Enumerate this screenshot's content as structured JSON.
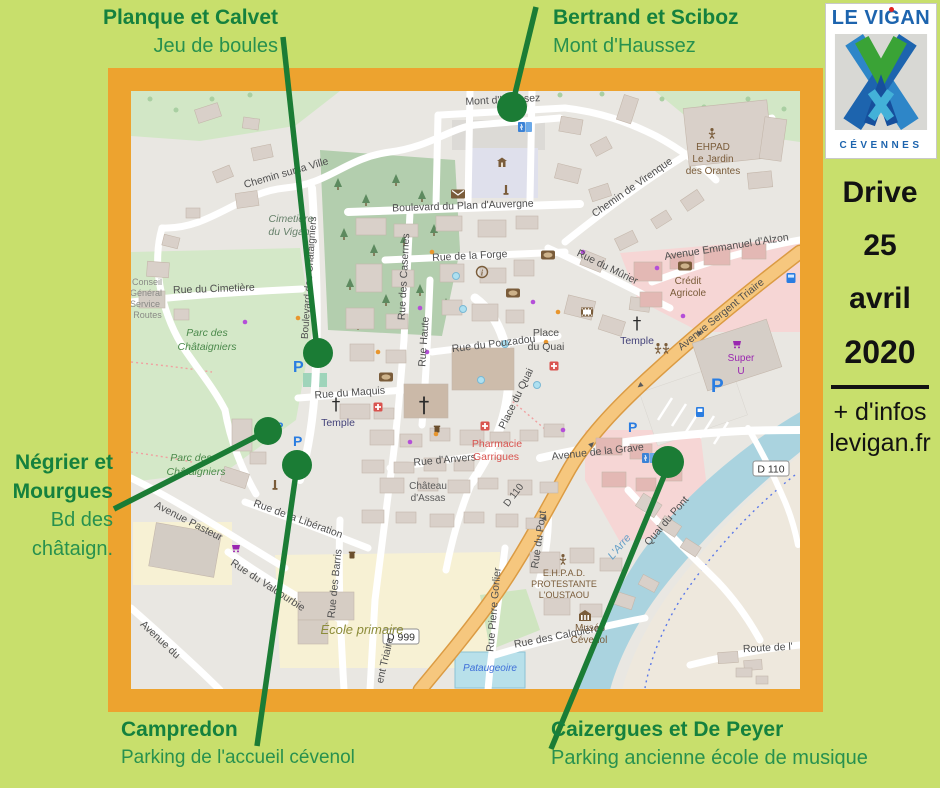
{
  "background_color": "#c8df6c",
  "frame_color": "#eda32f",
  "marker_color": "#1b7c35",
  "callouts": {
    "planque": {
      "title": "Planque et Calvet",
      "subtitle": "Jeu de boules"
    },
    "bertrand": {
      "title": "Bertrand et Sciboz",
      "subtitle": "Mont d'Haussez"
    },
    "negrier": {
      "title_line1": "Négrier et",
      "title_line2": "Mourgues",
      "subtitle_line1": "Bd des",
      "subtitle_line2": "châtaign."
    },
    "campredon": {
      "title": "Campredon",
      "subtitle": "Parking de l'accueil cévenol"
    },
    "caizergues": {
      "title": "Caizergues et De Peyer",
      "subtitle": "Parking ancienne école de musique"
    }
  },
  "logo": {
    "title": "LE VIGAN",
    "subtitle": "CÉVENNES"
  },
  "sidebar": {
    "date_line1": "Drive",
    "date_line2": "25",
    "date_line3": "avril",
    "date_line4": "2020",
    "info_line1": "+ d'infos",
    "info_line2": "levigan.fr"
  },
  "map": {
    "streets": {
      "chemin_sur_la_ville": "Chemin sur la Ville",
      "rue_du_cimetiere": "Rue du Cimetière",
      "bd_chataigniers": "Boulevard des Châtaigniers",
      "bd_plan_auvergne": "Boulevard du Plan d'Auvergne",
      "rue_de_la_forge": "Rue de la Forge",
      "rue_des_casernes": "Rue des Casernes",
      "rue_haute": "Rue Haute",
      "rue_du_pouzadou": "Rue du Pouzadou",
      "rue_du_maquis": "Rue du Maquis",
      "rue_d_anvers": "Rue d'Anvers",
      "place_line1": "Place",
      "place_line2": "du Quai",
      "place_du_quai": "Place du Quai",
      "chemin_de_virenque": "Chemin de Virenque",
      "rue_du_murier": "Rue du Mûrier",
      "av_emmanuel_alzon": "Avenue Emmanuel d'Alzon",
      "av_sergent_triaire": "Avenue Sergent Triaire",
      "av_sergent_triaire_bottom": "ent Triaire",
      "av_de_la_grave": "Avenue de la Grave",
      "av_pasteur": "Avenue Pasteur",
      "rue_liberation": "Rue de la Libération",
      "rue_des_barris": "Rue des Barris",
      "rue_du_valdourbie": "Rue du Valdourbie",
      "av_du_partial": "Avenue du",
      "rue_pierre_gorlier": "Rue Pierre Gorlier",
      "rue_des_calquieres": "Rue des Calquières",
      "rue_du_pont": "Rue du Pont",
      "quai_du_pont": "Quai du Pont",
      "route_de_l": "Route de l'",
      "mont_d_haussez": "Mont d'Haussez"
    },
    "refs": {
      "d999": "D 999",
      "d110": "D 110"
    },
    "places": {
      "cimetiere": [
        "Cimetière",
        "du Vigan"
      ],
      "parc": [
        "Parc des",
        "Châtaigniers"
      ],
      "conseil": [
        "Conseil",
        "Général",
        "Service",
        "s Routes"
      ],
      "temple": "Temple",
      "ehpad_orantes": [
        "EHPAD",
        "Le Jardin",
        "des Orantes"
      ],
      "ehpad_oustaou": [
        "E.H.P.A.D.",
        "PROTESTANTE",
        "L'OUSTAOU"
      ],
      "musee": [
        "Musée",
        "Cévenol"
      ],
      "credit_agricole": [
        "Crédit",
        "Agricole"
      ],
      "super_u": [
        "Super",
        "U"
      ],
      "pharmacie": [
        "Pharmacie",
        "Garrigues"
      ],
      "chateau": [
        "Château",
        "d'Assas"
      ],
      "ecole": "École primaire",
      "pataugeoire": "Pataugeoire",
      "river": "L'Arre",
      "parking_p": "P"
    }
  }
}
